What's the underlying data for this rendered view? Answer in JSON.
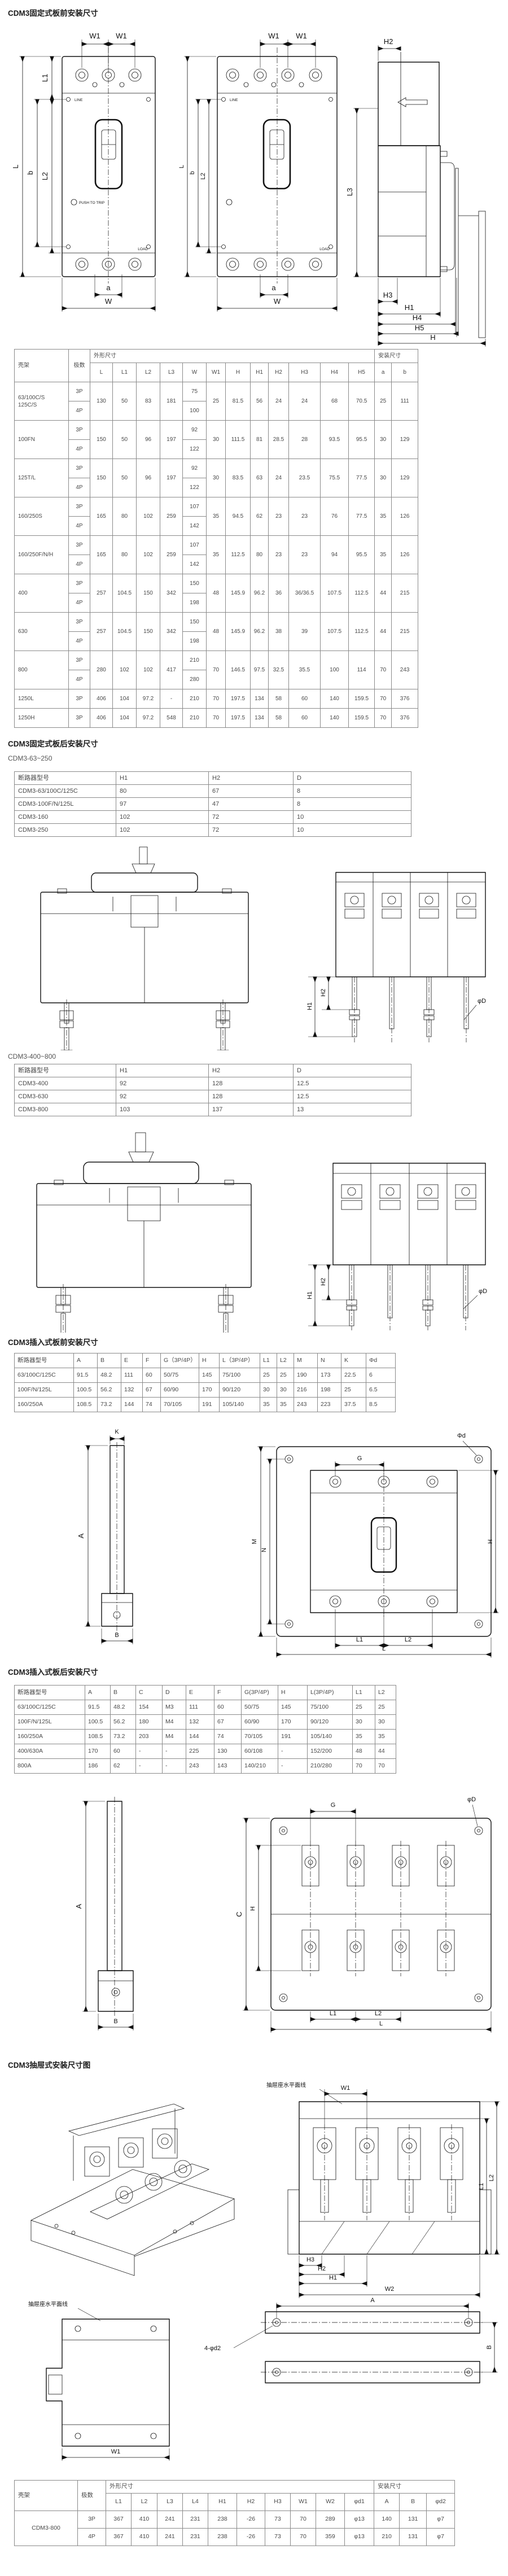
{
  "sections": {
    "s1": {
      "title": "CDM3固定式板前安装尺寸"
    },
    "s2": {
      "title": "CDM3固定式板后安装尺寸",
      "sub_a": "CDM3-63~250",
      "sub_b": "CDM3-400~800"
    },
    "s3": {
      "title": "CDM3插入式板前安装尺寸"
    },
    "s4": {
      "title": "CDM3插入式板后安装尺寸"
    },
    "s5": {
      "title": "CDM3抽屉式安装尺寸图"
    }
  },
  "dim": {
    "L": "L",
    "L1": "L1",
    "L2": "L2",
    "L3": "L3",
    "W": "W",
    "W1": "W1",
    "W2": "W2",
    "H": "H",
    "H1": "H1",
    "H2": "H2",
    "H3": "H3",
    "H4": "H4",
    "H5": "H5",
    "a": "a",
    "b": "b",
    "A": "A",
    "B": "B",
    "C": "C",
    "G": "G",
    "K": "K",
    "M": "M",
    "N": "N",
    "phi_d": "Φd",
    "phi_D": "φD",
    "phi_d2": "4-φd2",
    "line": "LINE",
    "load": "LOAD",
    "push": "PUSH TO TRIP",
    "plane_line": "抽屉座水平面线"
  },
  "tables": {
    "t1": {
      "rows": [
        [
          {
            "t": "壳架",
            "rs": 2,
            "l": 1
          },
          {
            "t": "极数",
            "rs": 2
          },
          {
            "t": "外形尺寸",
            "cs": 12,
            "l": 1
          },
          {
            "t": "安装尺寸",
            "cs": 2,
            "l": 1
          }
        ],
        [
          "L",
          "L1",
          "L2",
          "L3",
          "W",
          "W1",
          "H",
          "H1",
          "H2",
          "H3",
          "H4",
          "H5",
          "a",
          "b"
        ],
        [
          {
            "t": "63/100C/S\n125C/S",
            "rs": 2,
            "l": 1
          },
          "3P",
          {
            "t": "130",
            "rs": 2
          },
          {
            "t": "50",
            "rs": 2
          },
          {
            "t": "83",
            "rs": 2
          },
          {
            "t": "181",
            "rs": 2
          },
          "75",
          {
            "t": "25",
            "rs": 2
          },
          {
            "t": "81.5",
            "rs": 2
          },
          {
            "t": "56",
            "rs": 2
          },
          {
            "t": "24",
            "rs": 2
          },
          {
            "t": "24",
            "rs": 2
          },
          {
            "t": "68",
            "rs": 2
          },
          {
            "t": "70.5",
            "rs": 2
          },
          {
            "t": "25",
            "rs": 2
          },
          {
            "t": "111",
            "rs": 2
          }
        ],
        [
          "4P",
          "100"
        ],
        [
          {
            "t": "100FN",
            "rs": 2,
            "l": 1
          },
          "3P",
          {
            "t": "150",
            "rs": 2
          },
          {
            "t": "50",
            "rs": 2
          },
          {
            "t": "96",
            "rs": 2
          },
          {
            "t": "197",
            "rs": 2
          },
          "92",
          {
            "t": "30",
            "rs": 2
          },
          {
            "t": "111.5",
            "rs": 2
          },
          {
            "t": "81",
            "rs": 2
          },
          {
            "t": "28.5",
            "rs": 2
          },
          {
            "t": "28",
            "rs": 2
          },
          {
            "t": "93.5",
            "rs": 2
          },
          {
            "t": "95.5",
            "rs": 2
          },
          {
            "t": "30",
            "rs": 2
          },
          {
            "t": "129",
            "rs": 2
          }
        ],
        [
          "4P",
          "122"
        ],
        [
          {
            "t": "125T/L",
            "rs": 2,
            "l": 1
          },
          "3P",
          {
            "t": "150",
            "rs": 2
          },
          {
            "t": "50",
            "rs": 2
          },
          {
            "t": "96",
            "rs": 2
          },
          {
            "t": "197",
            "rs": 2
          },
          "92",
          {
            "t": "30",
            "rs": 2
          },
          {
            "t": "83.5",
            "rs": 2
          },
          {
            "t": "63",
            "rs": 2
          },
          {
            "t": "24",
            "rs": 2
          },
          {
            "t": "23.5",
            "rs": 2
          },
          {
            "t": "75.5",
            "rs": 2
          },
          {
            "t": "77.5",
            "rs": 2
          },
          {
            "t": "30",
            "rs": 2
          },
          {
            "t": "129",
            "rs": 2
          }
        ],
        [
          "4P",
          "122"
        ],
        [
          {
            "t": "160/250S",
            "rs": 2,
            "l": 1
          },
          "3P",
          {
            "t": "165",
            "rs": 2
          },
          {
            "t": "80",
            "rs": 2
          },
          {
            "t": "102",
            "rs": 2
          },
          {
            "t": "259",
            "rs": 2
          },
          "107",
          {
            "t": "35",
            "rs": 2
          },
          {
            "t": "94.5",
            "rs": 2
          },
          {
            "t": "62",
            "rs": 2
          },
          {
            "t": "23",
            "rs": 2
          },
          {
            "t": "23",
            "rs": 2
          },
          {
            "t": "76",
            "rs": 2
          },
          {
            "t": "77.5",
            "rs": 2
          },
          {
            "t": "35",
            "rs": 2
          },
          {
            "t": "126",
            "rs": 2
          }
        ],
        [
          "4P",
          "142"
        ],
        [
          {
            "t": "160/250F/N/H",
            "rs": 2,
            "l": 1
          },
          "3P",
          {
            "t": "165",
            "rs": 2
          },
          {
            "t": "80",
            "rs": 2
          },
          {
            "t": "102",
            "rs": 2
          },
          {
            "t": "259",
            "rs": 2
          },
          "107",
          {
            "t": "35",
            "rs": 2
          },
          {
            "t": "112.5",
            "rs": 2
          },
          {
            "t": "80",
            "rs": 2
          },
          {
            "t": "23",
            "rs": 2
          },
          {
            "t": "23",
            "rs": 2
          },
          {
            "t": "94",
            "rs": 2
          },
          {
            "t": "95.5",
            "rs": 2
          },
          {
            "t": "35",
            "rs": 2
          },
          {
            "t": "126",
            "rs": 2
          }
        ],
        [
          "4P",
          "142"
        ],
        [
          {
            "t": "400",
            "rs": 2,
            "l": 1
          },
          "3P",
          {
            "t": "257",
            "rs": 2
          },
          {
            "t": "104.5",
            "rs": 2
          },
          {
            "t": "150",
            "rs": 2
          },
          {
            "t": "342",
            "rs": 2
          },
          "150",
          {
            "t": "48",
            "rs": 2
          },
          {
            "t": "145.9",
            "rs": 2
          },
          {
            "t": "96.2",
            "rs": 2
          },
          {
            "t": "36",
            "rs": 2
          },
          {
            "t": "36/36.5",
            "rs": 2
          },
          {
            "t": "107.5",
            "rs": 2
          },
          {
            "t": "112.5",
            "rs": 2
          },
          {
            "t": "44",
            "rs": 2
          },
          {
            "t": "215",
            "rs": 2
          }
        ],
        [
          "4P",
          "198"
        ],
        [
          {
            "t": "630",
            "rs": 2,
            "l": 1
          },
          "3P",
          {
            "t": "257",
            "rs": 2
          },
          {
            "t": "104.5",
            "rs": 2
          },
          {
            "t": "150",
            "rs": 2
          },
          {
            "t": "342",
            "rs": 2
          },
          "150",
          {
            "t": "48",
            "rs": 2
          },
          {
            "t": "145.9",
            "rs": 2
          },
          {
            "t": "96.2",
            "rs": 2
          },
          {
            "t": "38",
            "rs": 2
          },
          {
            "t": "39",
            "rs": 2
          },
          {
            "t": "107.5",
            "rs": 2
          },
          {
            "t": "112.5",
            "rs": 2
          },
          {
            "t": "44",
            "rs": 2
          },
          {
            "t": "215",
            "rs": 2
          }
        ],
        [
          "4P",
          "198"
        ],
        [
          {
            "t": "800",
            "rs": 2,
            "l": 1
          },
          "3P",
          {
            "t": "280",
            "rs": 2
          },
          {
            "t": "102",
            "rs": 2
          },
          {
            "t": "102",
            "rs": 2
          },
          {
            "t": "417",
            "rs": 2
          },
          "210",
          {
            "t": "70",
            "rs": 2
          },
          {
            "t": "146.5",
            "rs": 2
          },
          {
            "t": "97.5",
            "rs": 2
          },
          {
            "t": "32.5",
            "rs": 2
          },
          {
            "t": "35.5",
            "rs": 2
          },
          {
            "t": "100",
            "rs": 2
          },
          {
            "t": "114",
            "rs": 2
          },
          {
            "t": "70",
            "rs": 2
          },
          {
            "t": "243",
            "rs": 2
          }
        ],
        [
          "4P",
          "280"
        ],
        [
          {
            "t": "1250L",
            "l": 1
          },
          "3P",
          "406",
          "104",
          "97.2",
          "-",
          "210",
          "70",
          "197.5",
          "134",
          "58",
          "60",
          "140",
          "159.5",
          "70",
          "376"
        ],
        [
          {
            "t": "1250H",
            "l": 1
          },
          "3P",
          "406",
          "104",
          "97.2",
          "548",
          "210",
          "70",
          "197.5",
          "134",
          "58",
          "60",
          "140",
          "159.5",
          "70",
          "376"
        ]
      ]
    },
    "t2": {
      "rows": [
        [
          "断路器型号",
          "H1",
          "H2",
          "D"
        ],
        [
          "CDM3-63/100C/125C",
          "80",
          "67",
          "8"
        ],
        [
          "CDM3-100F/N/125L",
          "97",
          "47",
          "8"
        ],
        [
          "CDM3-160",
          "102",
          "72",
          "10"
        ],
        [
          "CDM3-250",
          "102",
          "72",
          "10"
        ]
      ]
    },
    "t3": {
      "rows": [
        [
          "断路器型号",
          "H1",
          "H2",
          "D"
        ],
        [
          "CDM3-400",
          "92",
          "128",
          "12.5"
        ],
        [
          "CDM3-630",
          "92",
          "128",
          "12.5"
        ],
        [
          "CDM3-800",
          "103",
          "137",
          "13"
        ]
      ]
    },
    "t4": {
      "rows": [
        [
          "断路器型号",
          "A",
          "B",
          "E",
          "F",
          "G（3P/4P）",
          "H",
          "L（3P/4P）",
          "L1",
          "L2",
          "M",
          "N",
          "K",
          "Φd"
        ],
        [
          "63/100C/125C",
          "91.5",
          "48.2",
          "111",
          "60",
          "50/75",
          "145",
          "75/100",
          "25",
          "25",
          "190",
          "173",
          "22.5",
          "6"
        ],
        [
          "100F/N/125L",
          "100.5",
          "56.2",
          "132",
          "67",
          "60/90",
          "170",
          "90/120",
          "30",
          "30",
          "216",
          "198",
          "25",
          "6.5"
        ],
        [
          "160/250A",
          "108.5",
          "73.2",
          "144",
          "74",
          "70/105",
          "191",
          "105/140",
          "35",
          "35",
          "243",
          "223",
          "37.5",
          "8.5"
        ]
      ]
    },
    "t5": {
      "rows": [
        [
          "断路器型号",
          "A",
          "B",
          "C",
          "D",
          "E",
          "F",
          "G(3P/4P)",
          "H",
          "L(3P/4P)",
          "L1",
          "L2"
        ],
        [
          "63/100C/125C",
          "91.5",
          "48.2",
          "154",
          "M3",
          "111",
          "60",
          "50/75",
          "145",
          "75/100",
          "25",
          "25"
        ],
        [
          "100F/N/125L",
          "100.5",
          "56.2",
          "180",
          "M4",
          "132",
          "67",
          "60/90",
          "170",
          "90/120",
          "30",
          "30"
        ],
        [
          "160/250A",
          "108.5",
          "73.2",
          "203",
          "M4",
          "144",
          "74",
          "70/105",
          "191",
          "105/140",
          "35",
          "35"
        ],
        [
          "400/630A",
          "170",
          "60",
          "-",
          "-",
          "225",
          "130",
          "60/108",
          "-",
          "152/200",
          "48",
          "44"
        ],
        [
          "800A",
          "186",
          "62",
          "-",
          "-",
          "243",
          "143",
          "140/210",
          "-",
          "210/280",
          "70",
          "70"
        ]
      ]
    },
    "t6": {
      "rows": [
        [
          {
            "t": "壳架",
            "rs": 2,
            "l": 1
          },
          {
            "t": "极数",
            "rs": 2,
            "l": 1
          },
          {
            "t": "外形尺寸",
            "cs": 10,
            "l": 1
          },
          {
            "t": "安装尺寸",
            "cs": 3,
            "l": 1
          }
        ],
        [
          "L1",
          "L2",
          "L3",
          "L4",
          "H1",
          "H2",
          "H3",
          "W1",
          "W2",
          "φd1",
          "A",
          "B",
          "φd2"
        ],
        [
          {
            "t": "CDM3-800",
            "rs": 2
          },
          "3P",
          "367",
          "410",
          "241",
          "231",
          "238",
          "-26",
          "73",
          "70",
          "289",
          "φ13",
          "140",
          "131",
          "φ7"
        ],
        [
          "4P",
          "367",
          "410",
          "241",
          "231",
          "238",
          "-26",
          "73",
          "70",
          "359",
          "φ13",
          "210",
          "131",
          "φ7"
        ]
      ]
    }
  }
}
